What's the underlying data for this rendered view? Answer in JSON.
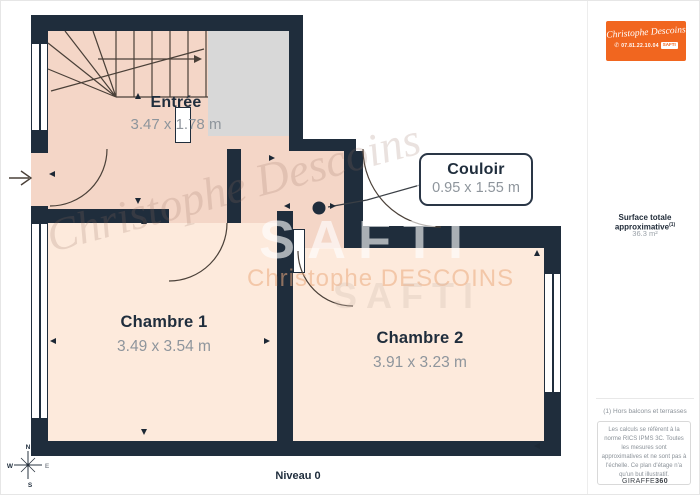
{
  "plan": {
    "rooms": [
      {
        "name": "Entrée",
        "dims": "3.47 x 1.78 m"
      },
      {
        "name": "Chambre 1",
        "dims": "3.49 x 3.54 m"
      },
      {
        "name": "Chambre 2",
        "dims": "3.91 x 3.23 m"
      }
    ],
    "callout": {
      "name": "Couloir",
      "dims": "0.95 x 1.55 m"
    },
    "level_label": "Niveau 0",
    "compass": {
      "n": "N",
      "w": "W",
      "s": "S",
      "e": "E"
    },
    "colors": {
      "wall": "#1f2d3c",
      "room_upper": "#f4d6c7",
      "room_lower": "#fdeadc",
      "landing": "#d8d8d8",
      "accent_orange": "#f1661f"
    }
  },
  "watermark": {
    "script_large": "Christophe Descoins",
    "safti": "SAFTI",
    "agent_caps": "Christophe DESCOINS",
    "safti_faint": "SAFTI"
  },
  "sidebar": {
    "logo": {
      "script": "Christophe Descoins",
      "phone": "07.81.22.10.04",
      "badge": "SAFTI"
    },
    "surface_title": "Surface totale approximative",
    "surface_sup": "(1)",
    "surface_value": "36.3 m²",
    "footnote": "(1) Hors balcons et terrasses",
    "legal": "Les calculs se réfèrent à la norme RICS IPMS 3C. Toutes les mesures sont approximatives et ne sont pas à l'échelle. Ce plan d'étage n'a qu'un but illustratif.",
    "brand": "GIRAFFE",
    "brand_suffix": "360"
  }
}
